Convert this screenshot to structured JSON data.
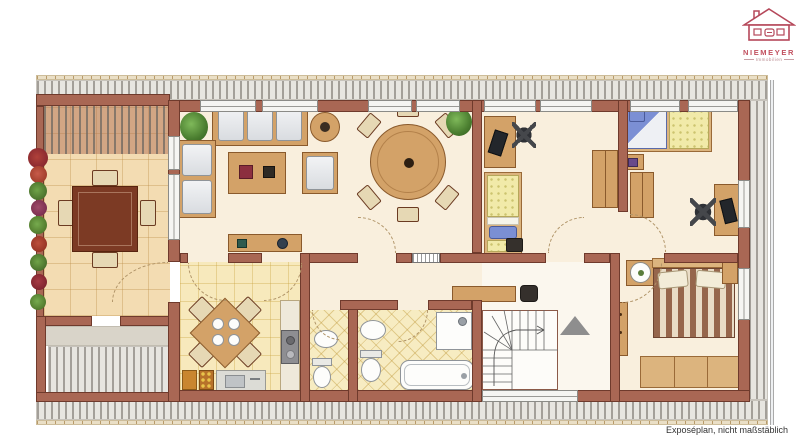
{
  "caption": "Exposéplan, nicht maßstäblich",
  "logo": {
    "company": "NIEMEYER",
    "tagline": "Immobilien",
    "brand_color": "#c2505f"
  },
  "colors": {
    "wall": "#a96754",
    "wall_border": "#6f3a2c",
    "interior_floor": "#f9efdd",
    "terrace_tile": "#f3dcb2",
    "kitchen_tile": "#f7e9bc",
    "bath_tile": "#f7ecc2",
    "deck_base": "#e7e5e0",
    "deck_stripe": "#a39f99",
    "wood": "#d3a268",
    "wood_dark": "#7c3a24",
    "bed_yellow": "#f1eaa9",
    "bed_blue": "#7b8fd4",
    "duvet_stripe": "#96664c",
    "plant_green": "#4a7d2f",
    "stairs_arrow": "#8e8e8e"
  }
}
